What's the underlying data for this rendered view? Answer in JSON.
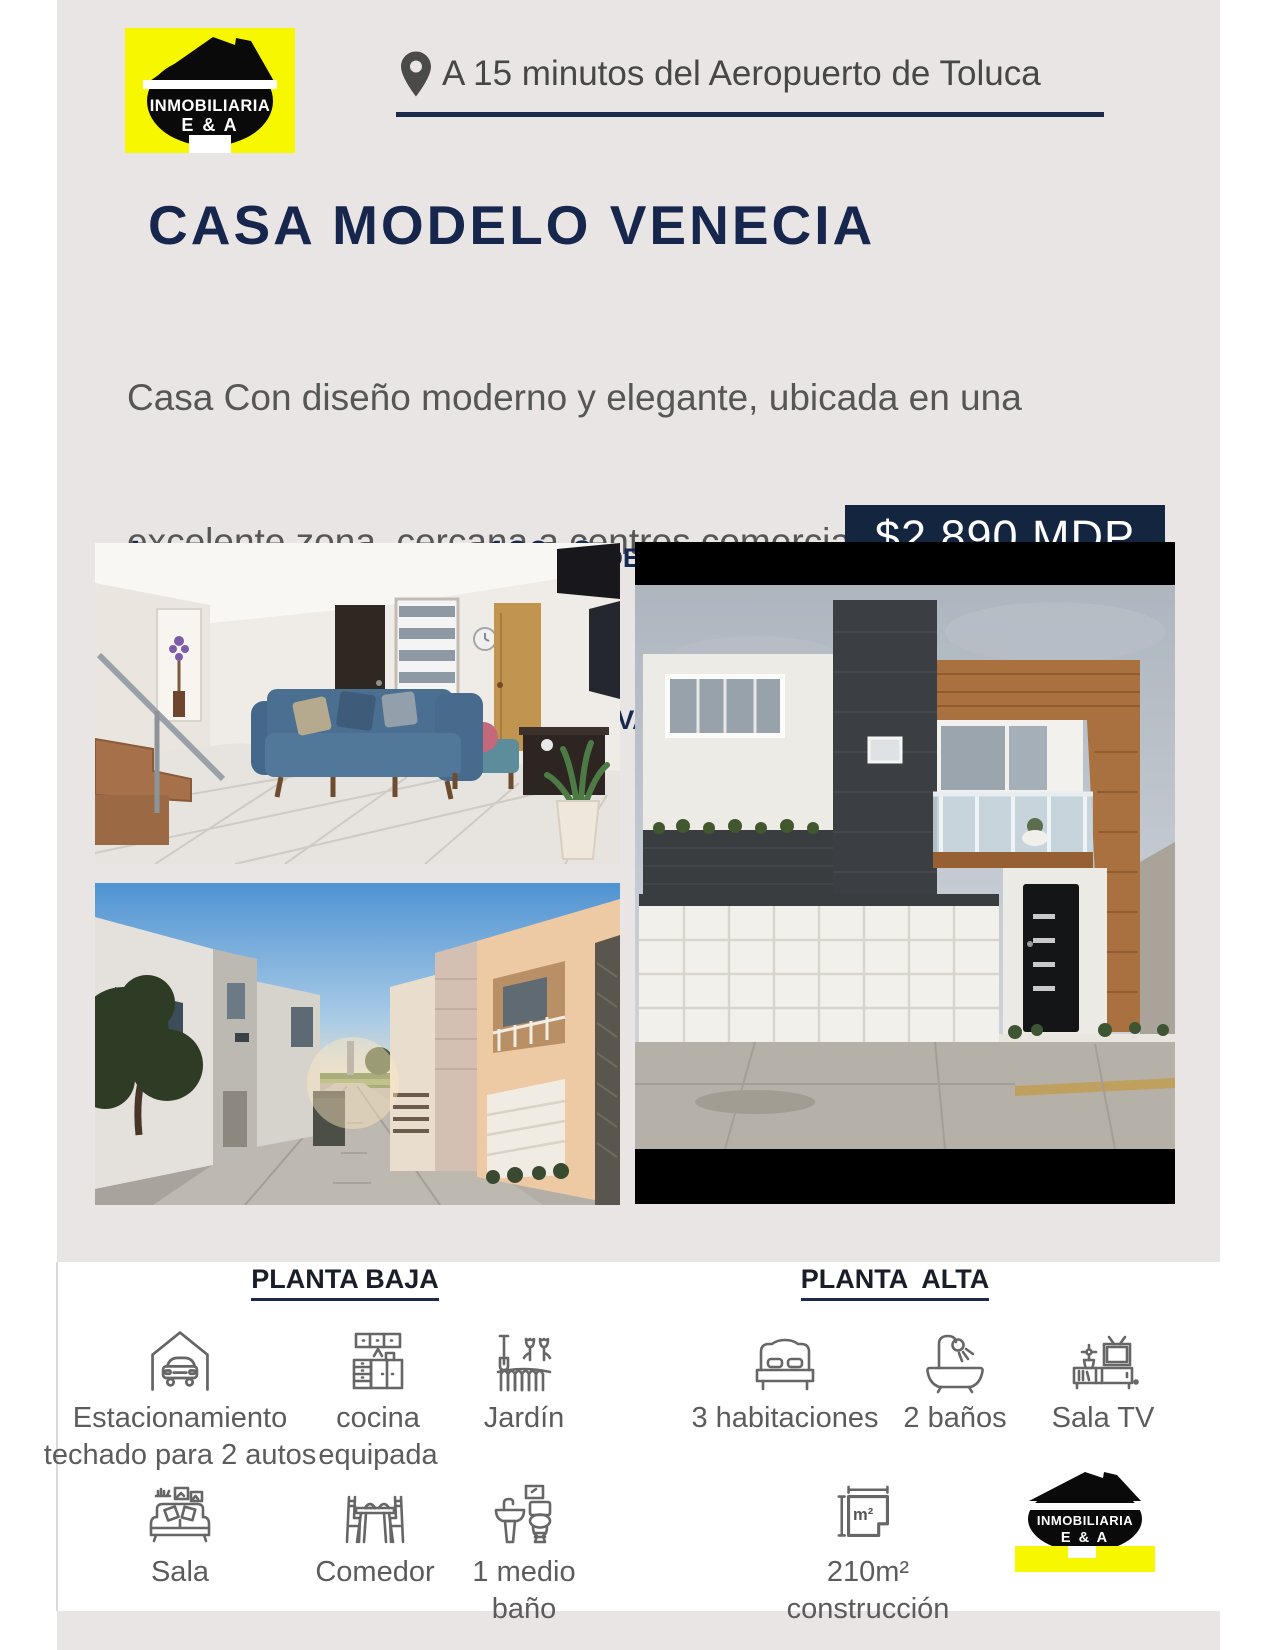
{
  "colors": {
    "page_bg": "#e9e5e4",
    "accent_navy": "#1b2a4d",
    "logo_yellow": "#f7f700",
    "text_gray": "#565656",
    "price_badge_bg": "#14253f"
  },
  "logo": {
    "line1": "INMOBILIARIA",
    "line2": "E & A"
  },
  "header": {
    "location": "A 15 minutos del Aeropuerto de Toluca"
  },
  "listing": {
    "title": "CASA MODELO VENECIA",
    "description": [
      "Casa Con diseño moderno y elegante, ubicada en una",
      "excelente zona, cercana a centros comerciales y salidas",
      "rápidas hacia CDMX"
    ],
    "highlight": [
      "Incluye excedente de 130m2 de",
      "terreno con salida a una  Privada"
    ],
    "price": "$2.890 MDP"
  },
  "features": {
    "planta_baja": {
      "header": "PLANTA BAJA",
      "items": [
        {
          "icon": "carport-icon",
          "lines": [
            "Estacionamiento",
            "techado para 2 autos"
          ]
        },
        {
          "icon": "kitchen-icon",
          "lines": [
            "cocina",
            "equipada"
          ]
        },
        {
          "icon": "garden-icon",
          "lines": [
            "Jardín"
          ]
        },
        {
          "icon": "sofa-icon",
          "lines": [
            "Sala"
          ]
        },
        {
          "icon": "dining-table-icon",
          "lines": [
            "Comedor"
          ]
        },
        {
          "icon": "half-bath-icon",
          "lines": [
            "1 medio",
            "baño"
          ]
        }
      ]
    },
    "planta_alta": {
      "header": "PLANTA  ALTA",
      "items": [
        {
          "icon": "bed-icon",
          "lines": [
            "3 habitaciones"
          ]
        },
        {
          "icon": "bathtub-icon",
          "lines": [
            "2 baños"
          ]
        },
        {
          "icon": "tv-stand-icon",
          "lines": [
            "Sala TV"
          ]
        },
        {
          "icon": "floor-area-icon",
          "icon_text": "m²",
          "lines": [
            "210m²",
            "construcción"
          ]
        }
      ]
    }
  }
}
